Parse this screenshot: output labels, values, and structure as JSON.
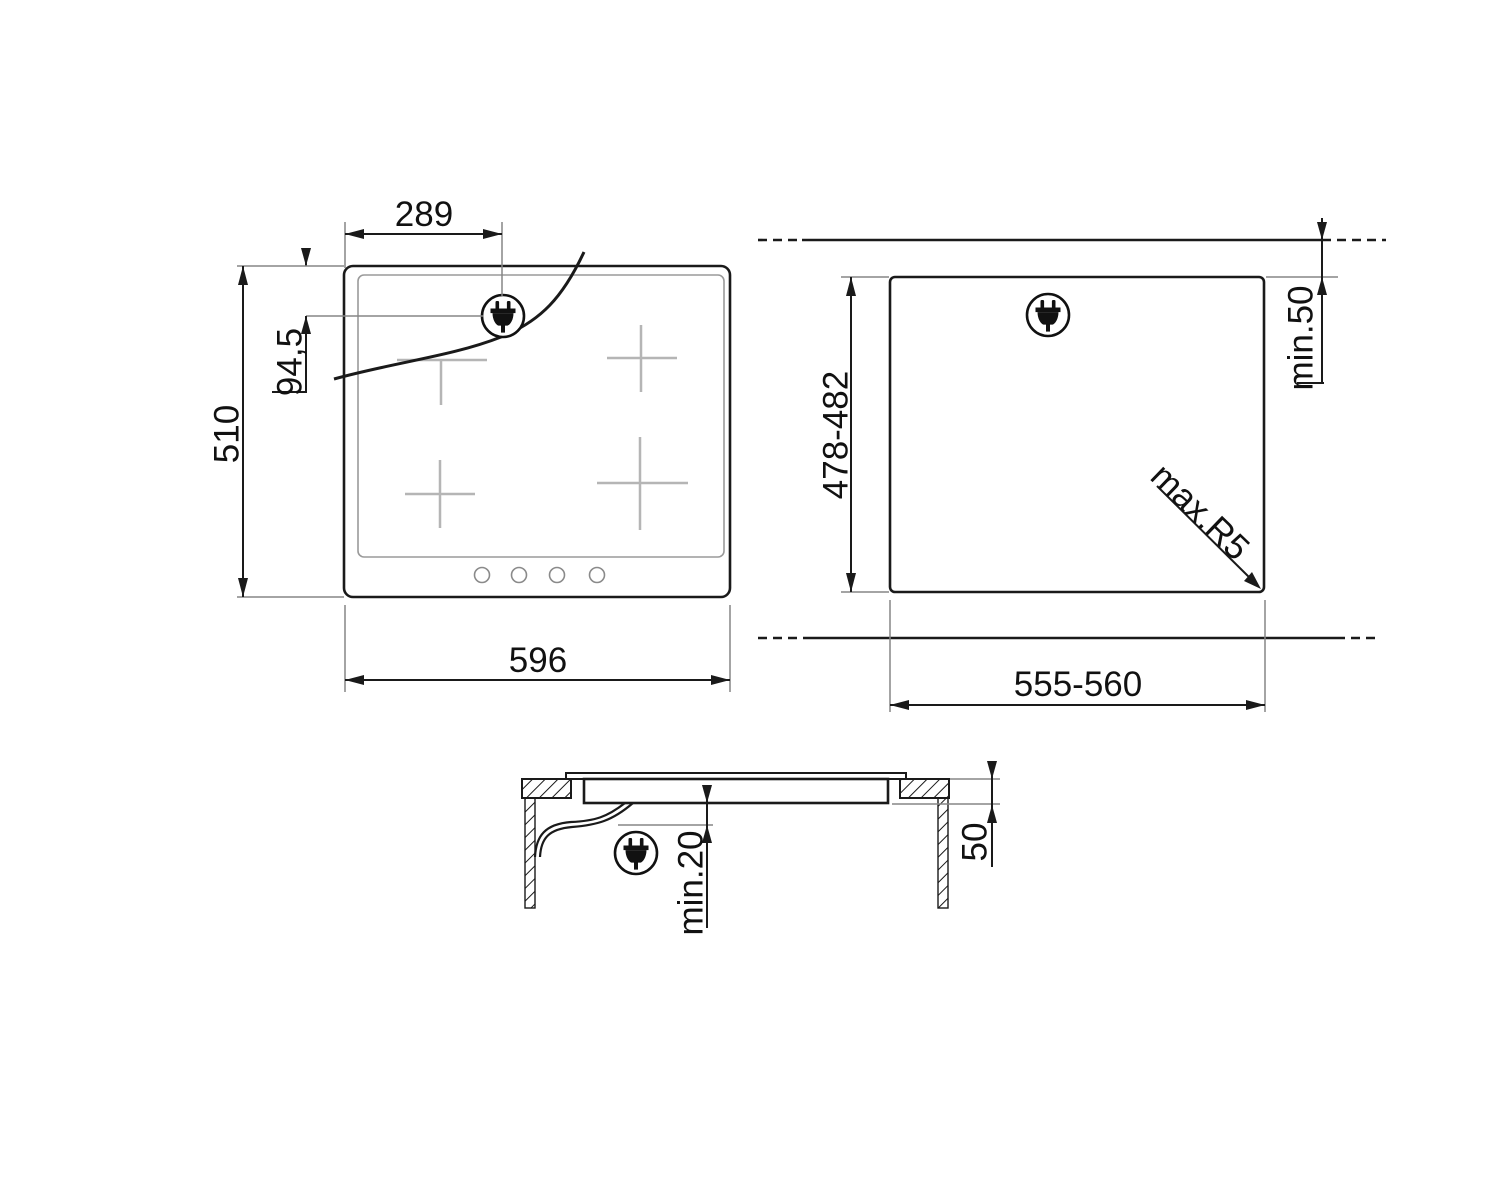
{
  "drawing_title": "hob-installation-dimension-drawing",
  "views": {
    "top": {
      "label": "hob-top-view",
      "width_mm": "596",
      "height_mm": "510",
      "plug_offset_x": "289",
      "plug_offset_y": "94,5"
    },
    "cutout": {
      "label": "worktop-cutout-view",
      "width_mm": "555-560",
      "depth_mm": "478-482",
      "min_rear_clearance": "min.50",
      "max_corner_radius": "max.R5"
    },
    "section": {
      "label": "side-section-view",
      "min_bottom_clearance": "min.20",
      "recess_depth": "50"
    }
  },
  "icons": {
    "plug": "power-plug-icon"
  },
  "colors": {
    "line": "#1a1a1a",
    "extension": "#858585",
    "zone_cross": "#b5b5b5",
    "background": "#ffffff"
  }
}
